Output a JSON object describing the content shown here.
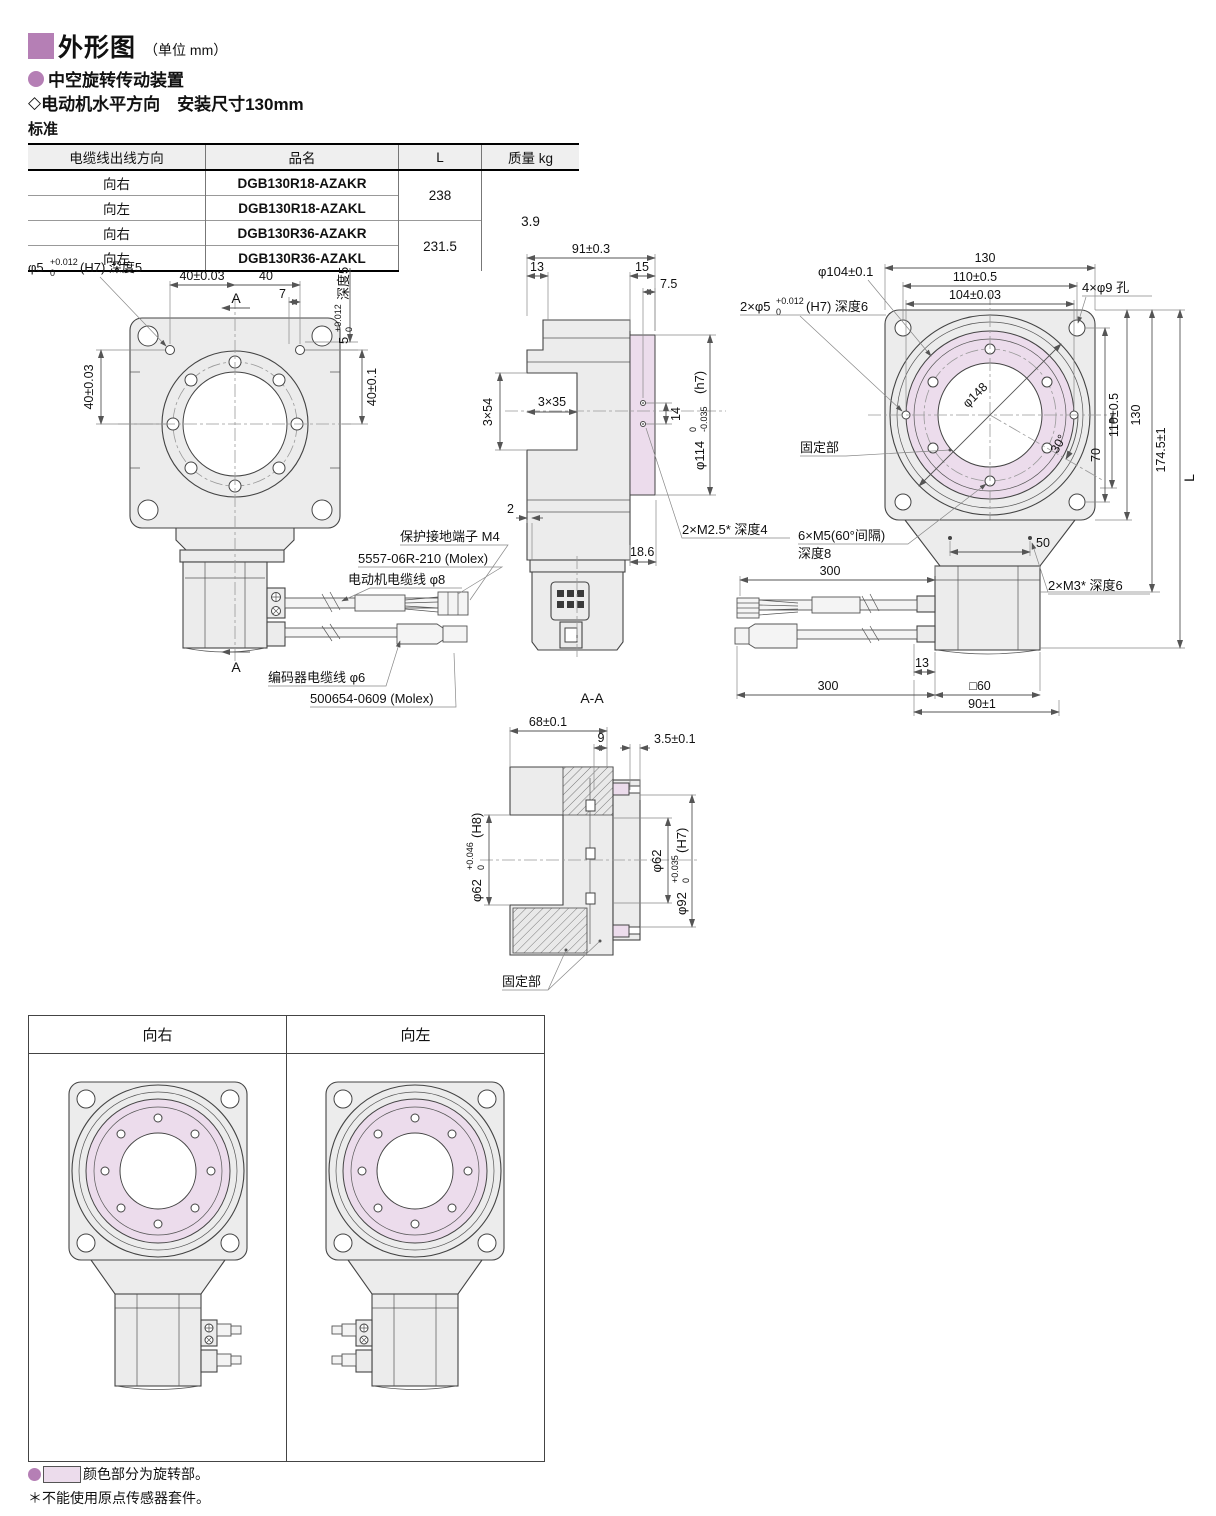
{
  "header": {
    "title": "外形图",
    "unit": "（单位 mm）",
    "product": "中空旋转传动装置",
    "diamond": "◇",
    "sub": "电动机水平方向　安装尺寸130mm",
    "standard": "标准"
  },
  "spec_table": {
    "col_dir": "电缆线出线方向",
    "col_name": "品名",
    "col_l": "L",
    "col_mass": "质量 kg",
    "rows": [
      {
        "dir": "向右",
        "name": "DGB130R18-AZAKR"
      },
      {
        "dir": "向左",
        "name": "DGB130R18-AZAKL"
      },
      {
        "dir": "向右",
        "name": "DGB130R36-AZAKR"
      },
      {
        "dir": "向左",
        "name": "DGB130R36-AZAKL"
      }
    ],
    "l1": "238",
    "l2": "231.5",
    "mass": "3.9"
  },
  "front": {
    "pin_pre": "φ5",
    "pin_sup": "+0.012",
    "pin_sub": "0",
    "pin_post": "(H7) 深度5",
    "dim40a": "40±0.03",
    "dim40b": "40",
    "dim7": "7",
    "secA_top": "A",
    "secA_bot": "A",
    "v5_pre": "5",
    "v5_sup": "+0.012",
    "v5_sub": "0",
    "v5_post": "深度5",
    "v40l": "40±0.03",
    "v40r": "40±0.1",
    "ground": "保护接地端子 M4",
    "molex1": "5557-06R-210 (Molex)",
    "motor_cable": "电动机电缆线 φ8",
    "encoder_cable": "编码器电缆线 φ6",
    "molex2": "500654-0609 (Molex)"
  },
  "side": {
    "dim91": "91±0.3",
    "dim13": "13",
    "dim15": "15",
    "dim75": "7.5",
    "dim3x54": "3×54",
    "dim3x35": "3×35",
    "dim14": "14",
    "d114_pre": "φ114",
    "d114_sup": "0",
    "d114_sub": "-0.035",
    "d114_post": "(h7)",
    "dim2": "2",
    "dim186": "18.6",
    "m25": "2×M2.5* 深度4"
  },
  "plan": {
    "dim130t": "130",
    "dim110t": "110±0.5",
    "dim104t": "104±0.03",
    "d104": "φ104±0.1",
    "pins_pre": "2×φ5",
    "pins_sup": "+0.012",
    "pins_sub": "0",
    "pins_post": "(H7) 深度6",
    "holes9": "4×φ9 孔",
    "d148": "φ148",
    "fixed": "固定部",
    "deg30": "30°",
    "dim70": "70",
    "dim110r": "110±0.5",
    "dim130r": "130",
    "dim1745": "174.5±1",
    "dimL": "L",
    "m5a": "6×M5(60°间隔)",
    "m5b": "深度8",
    "dim50": "50",
    "m3": "2×M3* 深度6",
    "dim300t": "300",
    "dim13b": "13",
    "dim300b": "300",
    "sq60": "□60",
    "dim90": "90±1"
  },
  "section": {
    "title": "A-A",
    "dim68": "68±0.1",
    "dim9": "9",
    "dim35": "3.5±0.1",
    "d62l_pre": "φ62",
    "d62l_sup": "+0.046",
    "d62l_sub": "0",
    "d62l_post": "(H8)",
    "d62r": "φ62",
    "d92_pre": "φ92",
    "d92_sup": "+0.035",
    "d92_sub": "0",
    "d92_post": "(H7)",
    "fixed": "固定部"
  },
  "orientation_table": {
    "right": "向右",
    "left": "向左"
  },
  "notes": {
    "legend": "颜色部分为旋转部。",
    "note": "＊不能使用原点传感器套件。"
  },
  "colors": {
    "accent": "#b57fb5",
    "pink": "#ecdcec"
  }
}
